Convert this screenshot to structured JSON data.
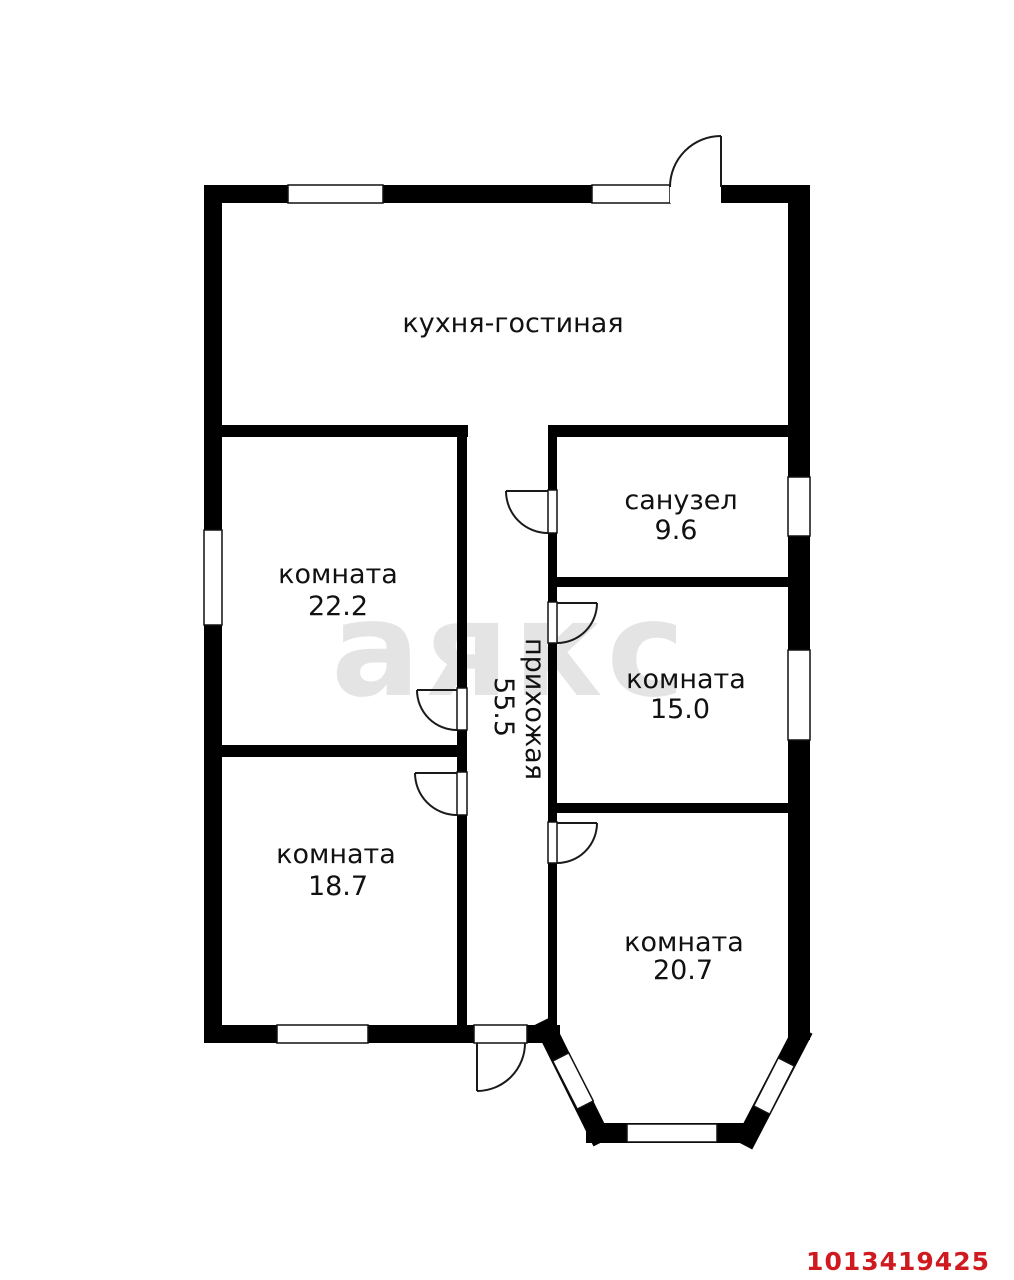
{
  "watermark": {
    "text": "аякс",
    "color": "#e4e4e4"
  },
  "listing_id": {
    "text": "1013419425",
    "color": "#cf1b20"
  },
  "rooms": {
    "kitchen": {
      "label": "кухня-гостиная"
    },
    "bathroom": {
      "label": "санузел",
      "area": "9.6"
    },
    "room1": {
      "label": "комната",
      "area": "22.2"
    },
    "hallway": {
      "label": "прихожая",
      "area": "55.5"
    },
    "room2": {
      "label": "комната",
      "area": "15.0"
    },
    "room3": {
      "label": "комната",
      "area": "18.7"
    },
    "room4": {
      "label": "комната",
      "area": "20.7"
    }
  }
}
